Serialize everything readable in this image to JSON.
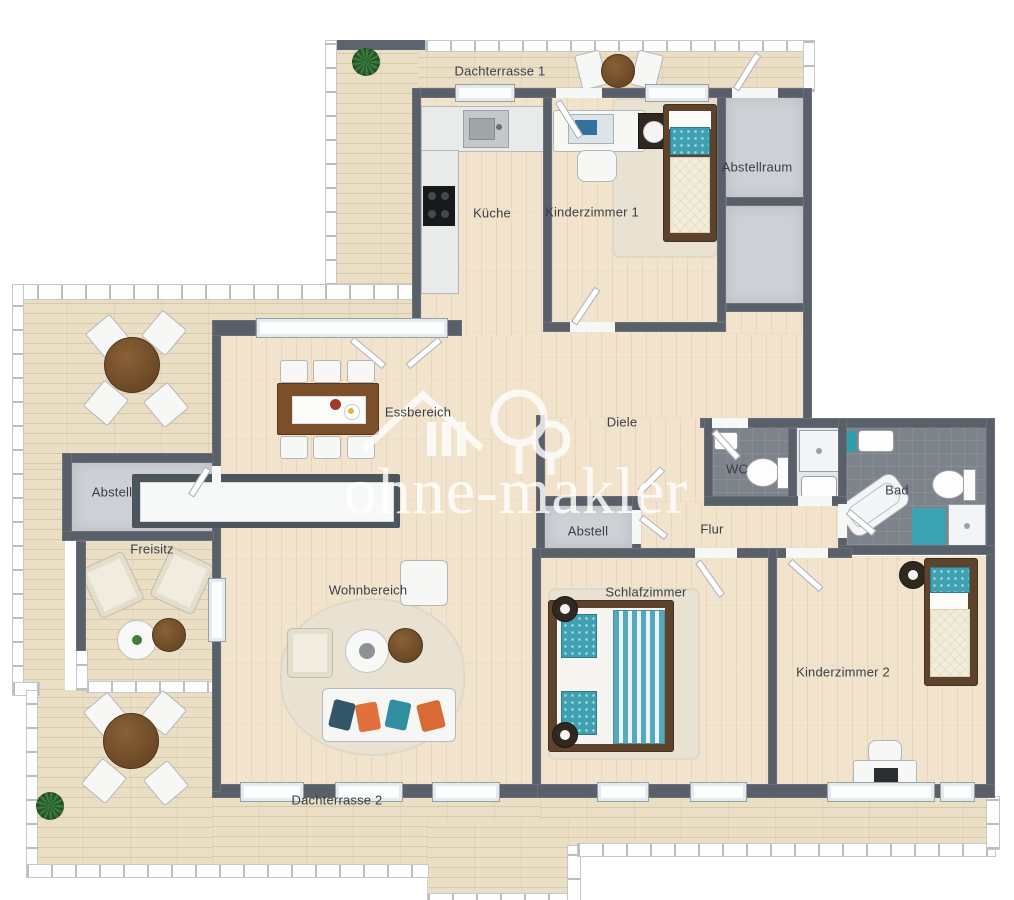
{
  "title": "3D Grundriss Penthouse-Wohnung",
  "watermark": {
    "brand": "ohne-makler",
    "logo": "house-and-trees-icon"
  },
  "labels": {
    "dachterrasse1": "Dachterrasse 1",
    "kueche": "Küche",
    "kinderzimmer1": "Kinderzimmer 1",
    "abstellraum": "Abstellraum",
    "essbereich": "Essbereich",
    "diele": "Diele",
    "abstell_left": "Abstell",
    "freisitz": "Freisitz",
    "wohnbereich": "Wohnbereich",
    "abstell_center": "Abstell",
    "flur": "Flur",
    "wc": "WC",
    "bad": "Bad",
    "schlafzimmer": "Schlafzimmer",
    "kinderzimmer2": "Kinderzimmer 2",
    "dachterrasse2": "Dachterrasse 2"
  },
  "colors": {
    "wall": "#59606a",
    "terrace_floor": "#eadec5",
    "wood_floor": "#f1e3cc",
    "gray_floor": "#cdd1d5",
    "bath_tile": "#7d838a",
    "accent_teal": "#3fa0b2",
    "furniture_wood": "#7a5230",
    "watermark_white": "rgba(255,255,255,0.8)"
  }
}
